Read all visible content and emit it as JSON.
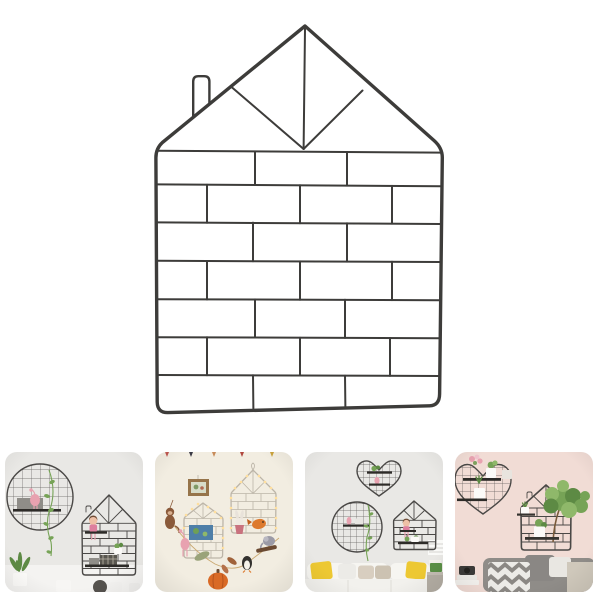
{
  "product": {
    "name": "house-shaped-wire-grid-wall-display",
    "description": "Black metal wire wall grid shaped like a house: triangular roof with fan lines, small chimney on the left slope, and a brick-pattern body, photographed on a plain white background",
    "parts": {
      "roof": "triangle roof with center line and two fan diagonals",
      "chimney": "small rounded chimney on left roof slope",
      "body": "seven alternating rows of brick-pattern wire rectangles"
    }
  },
  "thumbnails": [
    {
      "id": "lifestyle-1",
      "description": "Grey room wall with a round wire grid holding a black shelf, pink flamingo ornament and trailing plant, next to a house-shaped wire grid with a sitting doll, shelves and potted plants; white pots and a leafy plant along the bottom"
    },
    {
      "id": "lifestyle-2",
      "description": "Cream wall with two house-shaped wire grids wrapped in warm string lights and hung with plush toys: monkey, flamingo, rabbit, orange bird, elephant, penguin, leaves and a pumpkin, plus a small wooden picture frame under tiny bunting"
    },
    {
      "id": "lifestyle-3",
      "description": "Living room wall with heart, circle and house shaped wire grids holding shelves, plants, a flamingo and a doll, above a white sofa with yellow and beige cushions and a side table with a green box"
    },
    {
      "id": "lifestyle-4",
      "description": "Pink wall with a heart-shaped wire grid and a house-shaped wire grid holding white potted green plants, above a grey couch with a chevron pillow, plain grey and white pillows, books and a camera"
    }
  ],
  "palette": {
    "white": "#ffffff",
    "wire_dark": "#3d3c3a",
    "wire_mid": "#4a4846",
    "wire_light": "#bcb5a8",
    "shelf_black": "#2d2b28",
    "wall_gray": "#e9e8e5",
    "wall_cream": "#f2ede1",
    "wall_pink": "#f1dcd5",
    "floor_light": "#f4f3f1",
    "green": "#76a356",
    "green_dark": "#5d8a44",
    "green_light": "#8fb86a",
    "pink": "#e8a2b0",
    "pink_deep": "#dd7f9e",
    "skin": "#eec0a6",
    "hair": "#6f4c36",
    "yellow": "#edc832",
    "sofa_white": "#f6f5f1",
    "cushion_beige": "#d8cec0",
    "cushion_beige2": "#ccc2b2",
    "couch_gray": "#8f8c88",
    "chevron_gray": "#8b8884",
    "pillow_light": "#ecebe7",
    "wood": "#96744a",
    "orange": "#dd7a2e",
    "pumpkin": "#d96a26",
    "monkey": "#8a5a3a",
    "elephant": "#9b9aa6",
    "penguin": "#33312e",
    "cream_belly": "#f5f2ea",
    "light_warm": "#ffdf9e",
    "blue_art": "#4f7fa8",
    "box_green": "#5a8f46",
    "gray_item": "#8f8d88",
    "dark_item": "#59564f",
    "table_gray": "#c2bcb2",
    "string_tan": "#caa870",
    "leaf_sage": "#9aa37a",
    "leaf_rust": "#a0623a",
    "log_brown": "#6b4a32",
    "trunk_brown": "#7a5a3a",
    "white_pot": "#fbfaf8",
    "frame_white": "#fafaf8",
    "blanket_beige": "#cfc8bb"
  }
}
